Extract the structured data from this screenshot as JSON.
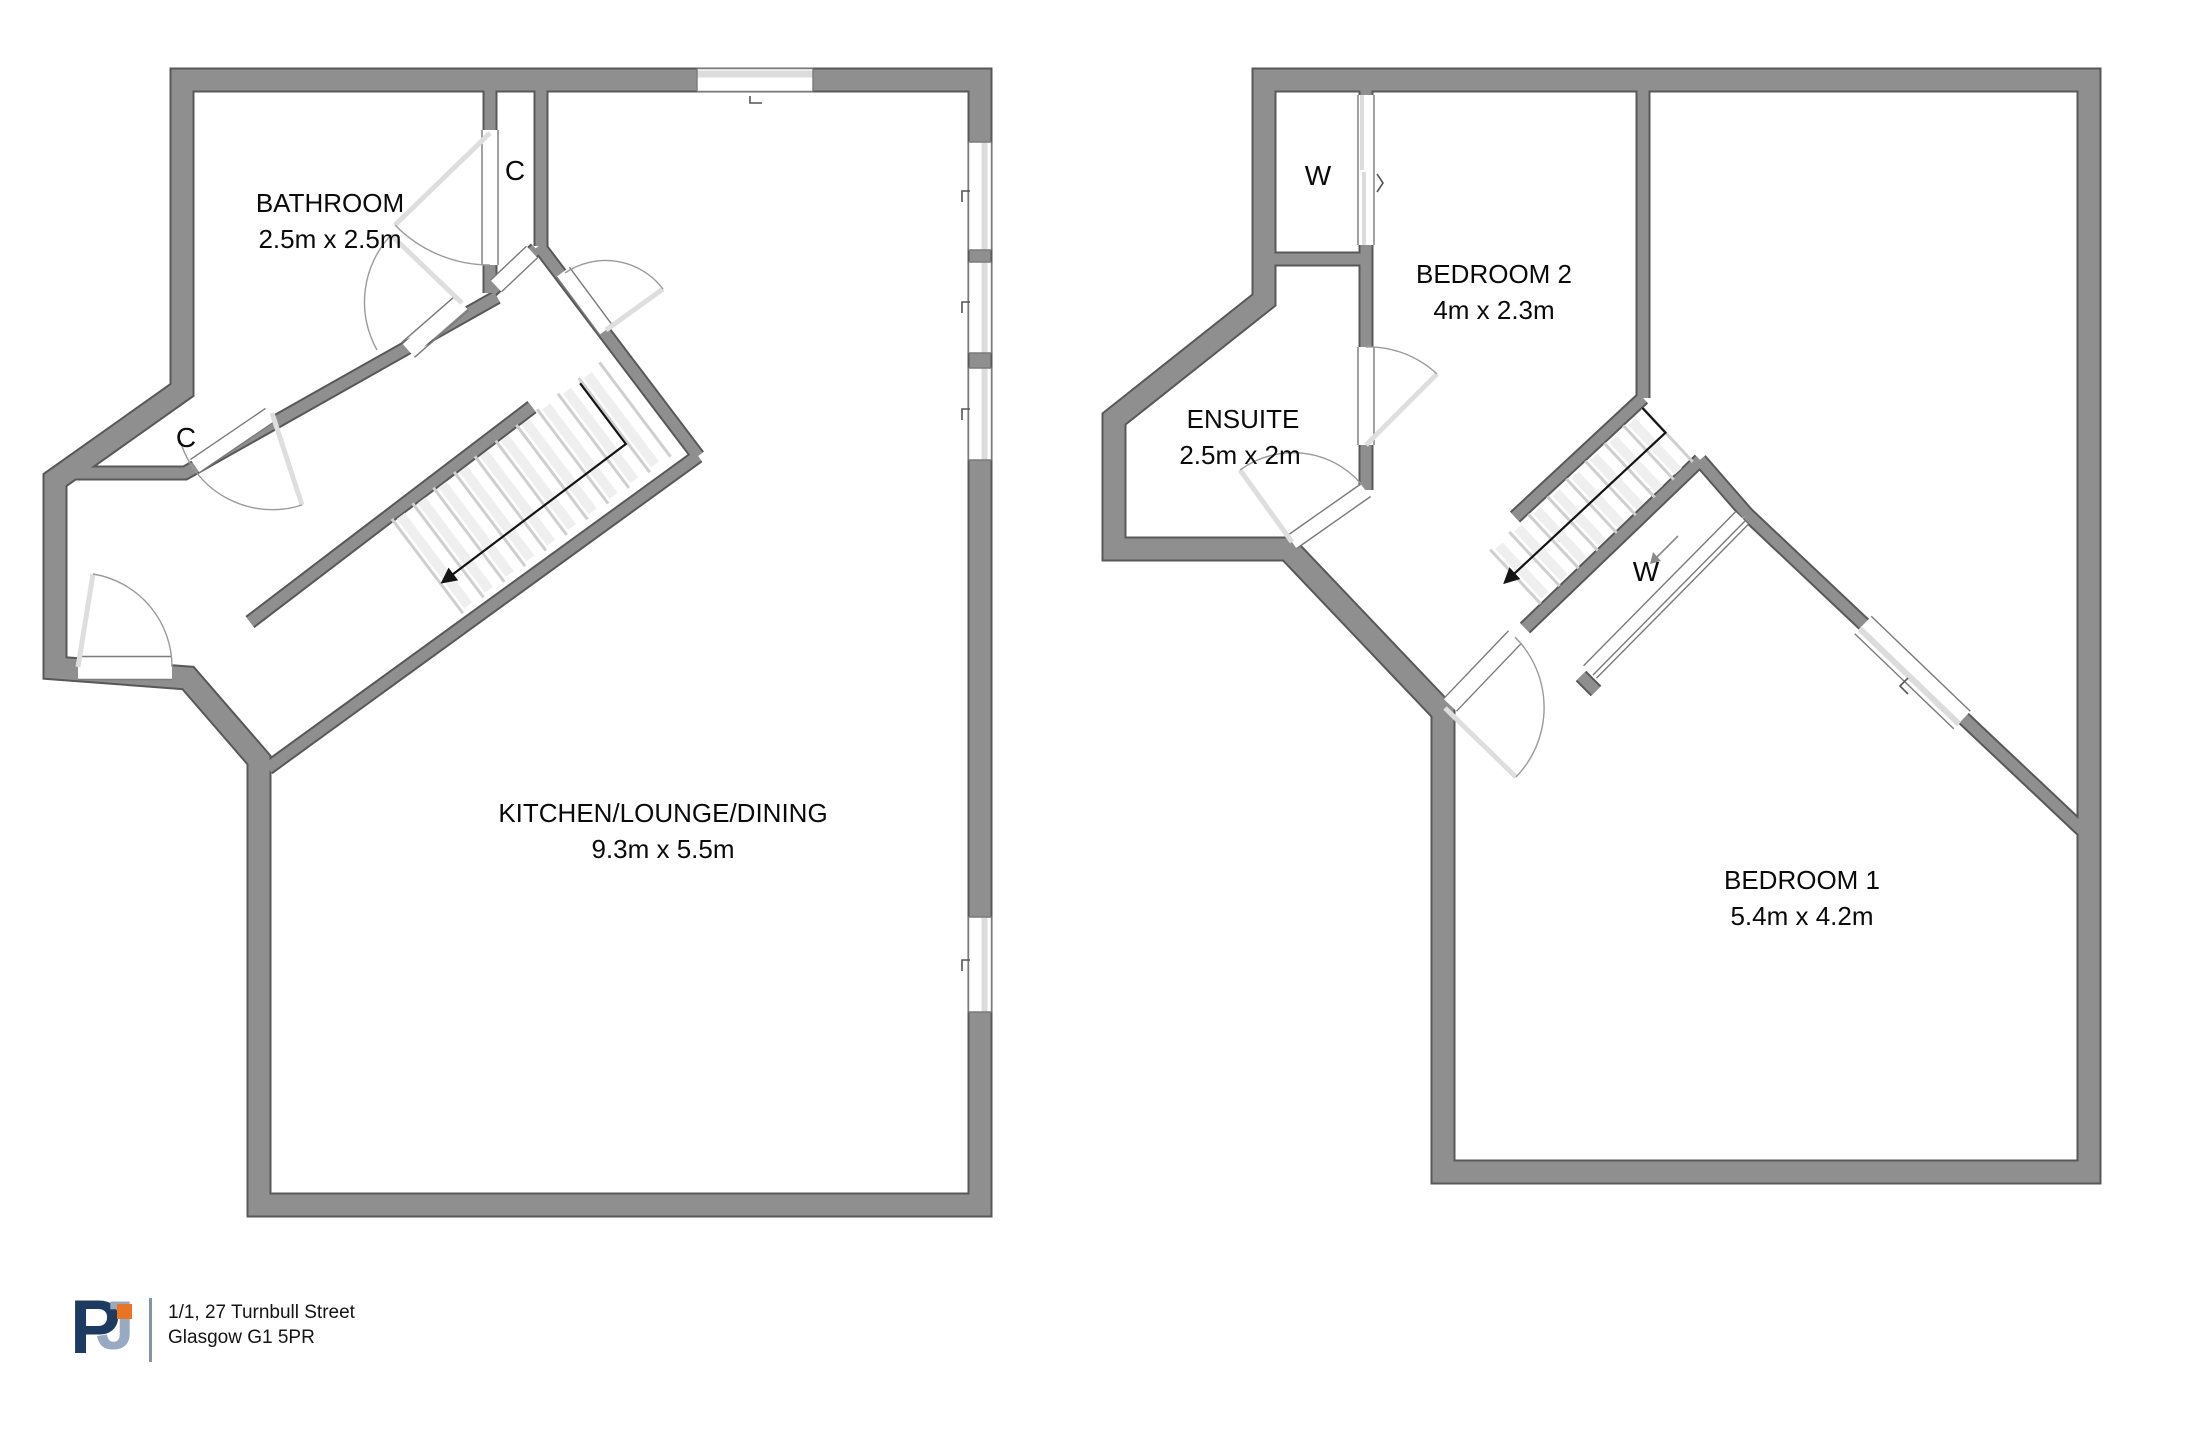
{
  "plans": {
    "left": {
      "rooms": [
        {
          "name": "BATHROOM",
          "dims": "2.5m x 2.5m"
        },
        {
          "name": "KITCHEN/LOUNGE/DINING",
          "dims": "9.3m x 5.5m"
        }
      ],
      "closet_labels": [
        "C",
        "C"
      ]
    },
    "right": {
      "rooms": [
        {
          "name": "BEDROOM 2",
          "dims": "4m x 2.3m"
        },
        {
          "name": "ENSUITE",
          "dims": "2.5m x 2m"
        },
        {
          "name": "BEDROOM 1",
          "dims": "5.4m x 4.2m"
        }
      ],
      "wardrobe_labels": [
        "W",
        "W"
      ]
    }
  },
  "footer": {
    "logo": {
      "letter_p": "P",
      "letter_j": "J"
    },
    "address_line1": "1/1, 27 Turnbull Street",
    "address_line2": "Glasgow G1 5PR"
  },
  "colors": {
    "wall_fill": "#8f8f8f",
    "wall_outline": "#585858",
    "logo_navy": "#1d3a60",
    "logo_steel": "#97aac2",
    "logo_orange": "#e87424"
  }
}
